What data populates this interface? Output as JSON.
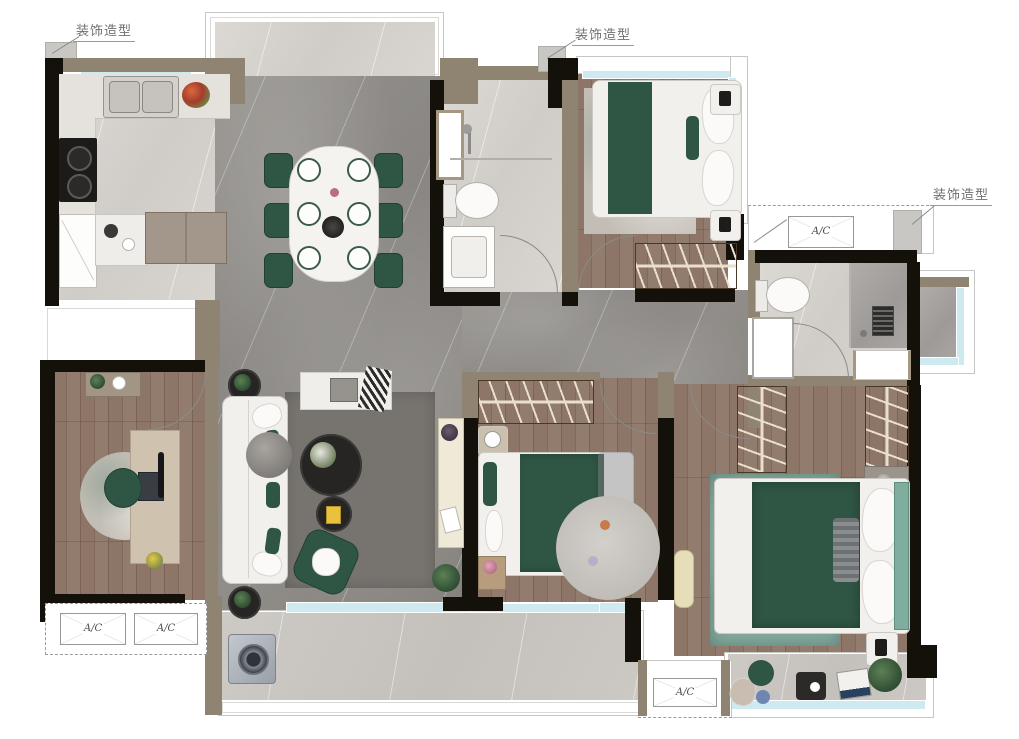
{
  "labels": {
    "deco_1": "装饰造型",
    "deco_2": "装饰造型",
    "deco_3": "装饰造型",
    "ac": [
      "A/C",
      "A/C",
      "A/C",
      "A/C"
    ]
  },
  "colors": {
    "wall": "#14100a",
    "partition": "#8f8371",
    "accent_green": "#2f5544",
    "glass_blue": "#cfe9f0",
    "wardrobe_brown": "#5f4a33",
    "marble_gray": "#8f8c88",
    "marble_pale": "#d8d4cf",
    "wood": "#8a7365",
    "rug_gray": "#77746f",
    "rug_teal": "#84aa9e",
    "balcony_tile": "#cac6c1",
    "annotation_text": "#6f6f6f"
  }
}
